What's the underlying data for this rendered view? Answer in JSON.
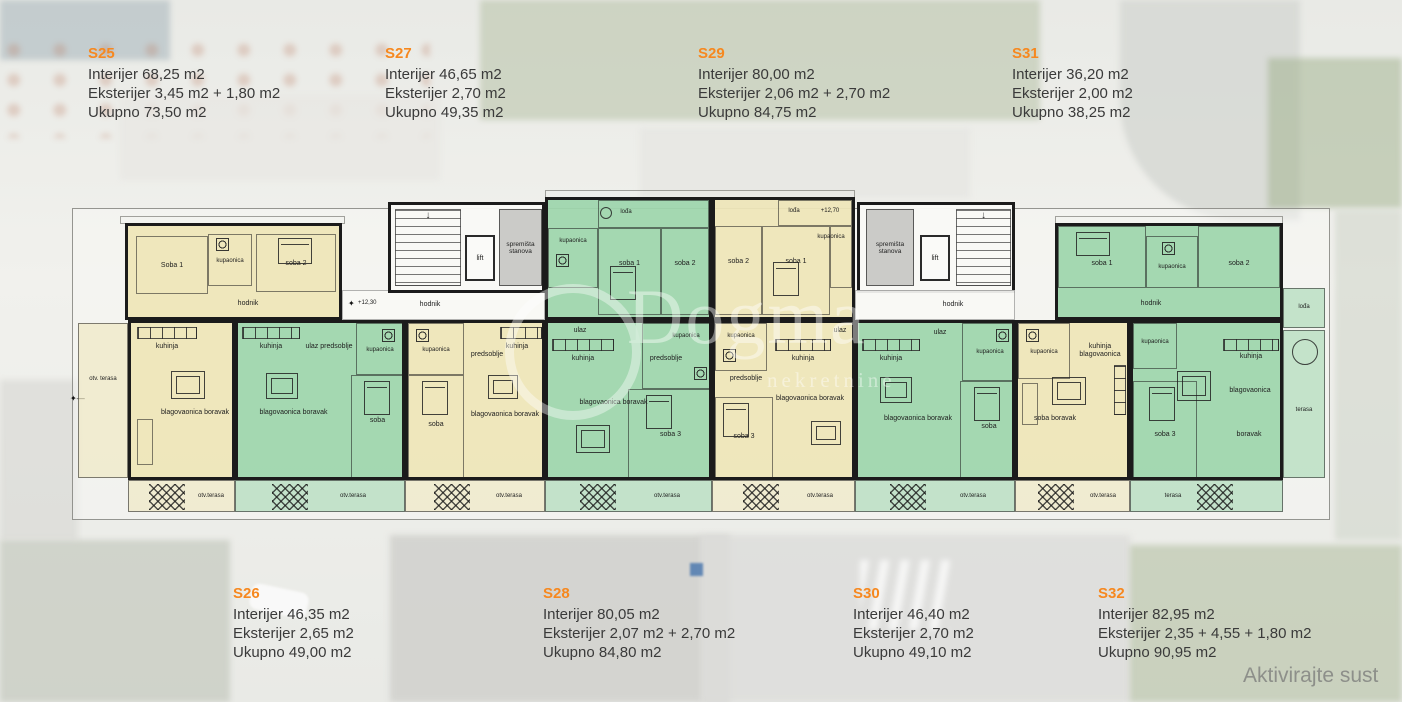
{
  "accent": "#f6881f",
  "colors": {
    "apartment_yellow": "#eee5b8",
    "apartment_green": "#9dd5ac",
    "wall": "#1b1b1b",
    "info_text": "#3a3a3a"
  },
  "header_units": [
    {
      "id": "S25",
      "interior": "Interijer 68,25 m2",
      "exterior": "Eksterijer 3,45 m2 + 1,80 m2",
      "total": "Ukupno 73,50 m2"
    },
    {
      "id": "S27",
      "interior": "Interijer 46,65 m2",
      "exterior": "Eksterijer 2,70 m2",
      "total": "Ukupno 49,35 m2"
    },
    {
      "id": "S29",
      "interior": "Interijer 80,00 m2",
      "exterior": "Eksterijer 2,06 m2 + 2,70 m2",
      "total": "Ukupno 84,75 m2"
    },
    {
      "id": "S31",
      "interior": "Interijer 36,20 m2",
      "exterior": "Eksterijer 2,00 m2",
      "total": "Ukupno 38,25 m2"
    }
  ],
  "footer_units": [
    {
      "id": "S26",
      "interior": "Interijer 46,35 m2",
      "exterior": "Eksterijer 2,65 m2",
      "total": "Ukupno 49,00 m2"
    },
    {
      "id": "S28",
      "interior": "Interijer 80,05 m2",
      "exterior": "Eksterijer 2,07 m2 + 2,70 m2",
      "total": "Ukupno 84,80 m2"
    },
    {
      "id": "S30",
      "interior": "Interijer 46,40 m2",
      "exterior": "Eksterijer 2,70 m2",
      "total": "Ukupno 49,10 m2"
    },
    {
      "id": "S32",
      "interior": "Interijer 82,95 m2",
      "exterior": "Eksterijer 2,35 + 4,55 + 1,80 m2",
      "total": "Ukupno 90,95 m2"
    }
  ],
  "watermark": {
    "brand": "Dogma",
    "sub": "nekretnine"
  },
  "os_watermark": "Aktivirajte sust",
  "plan": {
    "terrace_left": "otv. terasa",
    "core1": {
      "lift": "lift",
      "storage": "spremišta stanova",
      "hodnik": "hodnik",
      "level": "+12,30"
    },
    "core2": {
      "lift": "lift",
      "storage": "spremišta stanova",
      "hodnik": "hodnik"
    },
    "s25": {
      "soba1": "Soba 1",
      "kupaonica": "kupaonica",
      "soba2": "soba 2",
      "hodnik": "hodnik",
      "kuhinja": "kuhinja",
      "blagovaonica": "blagovaonica boravak",
      "terasa": "otv.terasa"
    },
    "s26": {
      "kuhinja": "kuhinja",
      "ulaz": "ulaz predsoblje",
      "kupaonica": "kupaonica",
      "blagovaonica": "blagovaonica boravak",
      "soba": "soba",
      "terasa": "otv.terasa"
    },
    "s27": {
      "kupaonica": "kupaonica",
      "predsoblje": "predsoblje",
      "kuhinja": "kuhinja",
      "soba": "soba",
      "blagovaonica": "blagovaonica boravak",
      "terasa": "otv.terasa"
    },
    "s28": {
      "loda": "lođa",
      "kupaonica_top": "kupaonica",
      "soba1": "soba 1",
      "soba2": "soba 2",
      "ulaz": "ulaz",
      "kuhinja": "kuhinja",
      "blagovaonica": "blagovaonica boravak",
      "predsoblje": "predsoblje",
      "kupaonica": "kupaonica",
      "soba3": "soba 3",
      "terasa": "otv.terasa"
    },
    "s29": {
      "loda": "lođa",
      "level": "+12,70",
      "soba2": "soba 2",
      "soba1": "soba 1",
      "kupaonica_top": "kupaonica",
      "kupaonica": "kupaonica",
      "predsoblje": "predsoblje",
      "kuhinja": "kuhinja",
      "ulaz": "ulaz",
      "blagovaonica": "blagovaonica boravak",
      "soba3": "soba 3",
      "terasa": "otv.terasa"
    },
    "s30": {
      "kuhinja": "kuhinja",
      "ulaz": "ulaz",
      "kupaonica": "kupaonica",
      "blagovaonica": "blagovaonica boravak",
      "soba": "soba",
      "terasa": "otv.terasa"
    },
    "s31": {
      "kupaonica": "kupaonica",
      "kuhinja": "kuhinja blagovaonica",
      "soba": "soba boravak",
      "terasa": "otv.terasa"
    },
    "s32": {
      "soba1": "soba 1",
      "kupaonica_top": "kupaonica",
      "soba2": "soba 2",
      "hodnik": "hodnik",
      "loda": "lođa",
      "kuhinja": "kuhinja",
      "kupaonica": "kupaonica",
      "blagovaonica": "blagovaonica",
      "soba3": "soba 3",
      "boravak": "boravak",
      "terasa": "terasa",
      "terasa_right": "terasa"
    }
  }
}
